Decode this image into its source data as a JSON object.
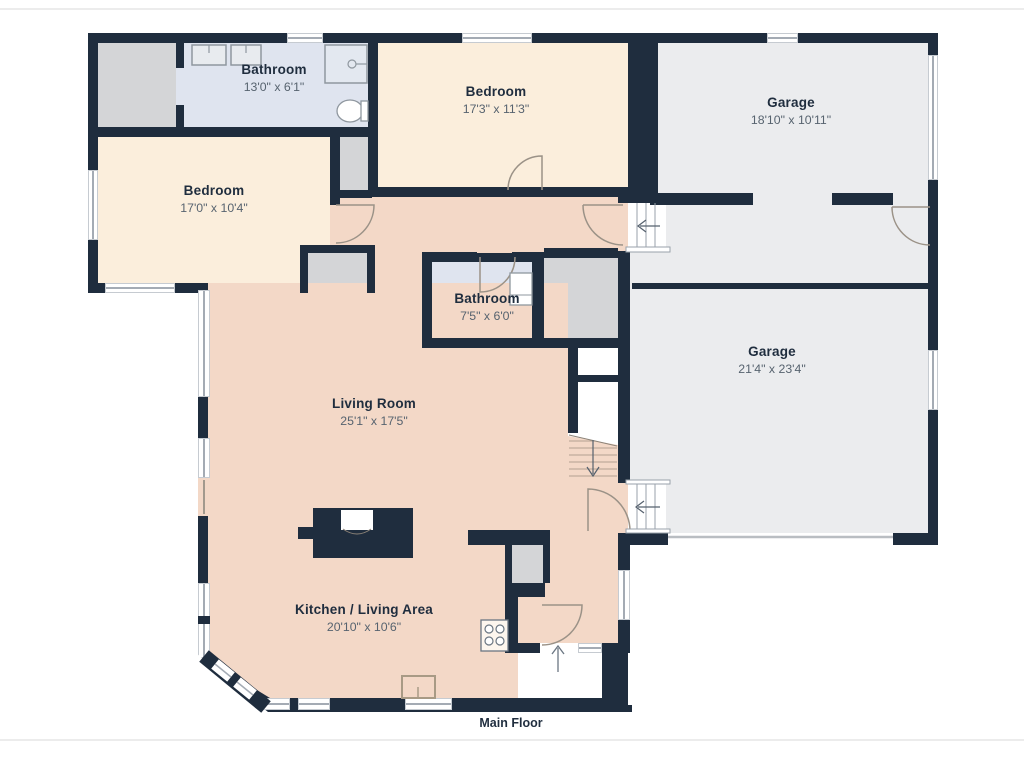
{
  "floor_title": "Main Floor",
  "rooms": {
    "bathroom_top": {
      "label": "Bathroom",
      "dims": "13'0\" x 6'1\""
    },
    "bedroom_top": {
      "label": "Bedroom",
      "dims": "17'3\" x 11'3\""
    },
    "garage_top": {
      "label": "Garage",
      "dims": "18'10\" x 10'11\""
    },
    "bedroom_left": {
      "label": "Bedroom",
      "dims": "17'0\" x 10'4\""
    },
    "bathroom_mid": {
      "label": "Bathroom",
      "dims": "7'5\" x 6'0\""
    },
    "garage_main": {
      "label": "Garage",
      "dims": "21'4\" x 23'4\""
    },
    "living_room": {
      "label": "Living Room",
      "dims": "25'1\" x 17'5\""
    },
    "kitchen": {
      "label": "Kitchen / Living Area",
      "dims": "20'10\" x 10'6\""
    }
  },
  "colors": {
    "wall": "#1f2d3e",
    "bedroom_floor": "#fbeedc",
    "living_floor": "#f3d8c7",
    "bathroom_floor": "#dfe4ef",
    "garage_floor": "#ebecee",
    "closet_floor": "#d4d5d7",
    "page_background": "#ffffff"
  }
}
